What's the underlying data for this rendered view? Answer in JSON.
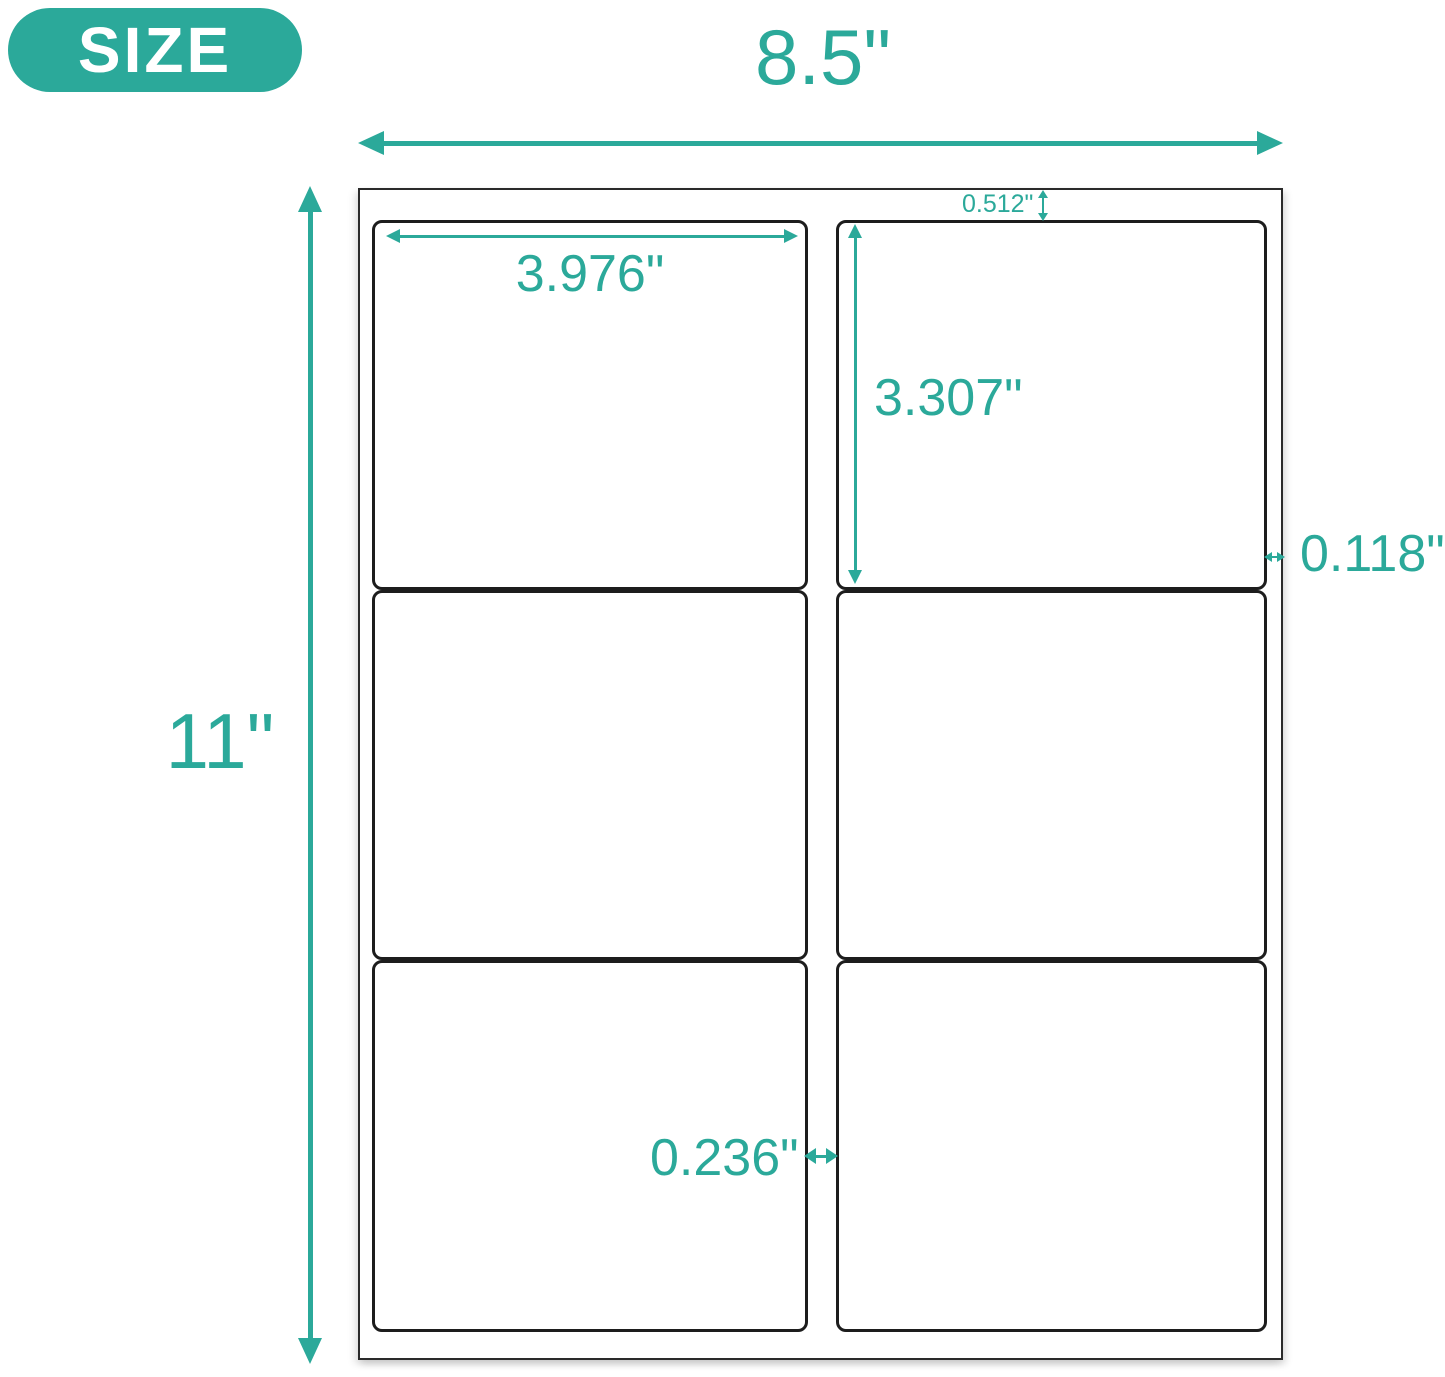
{
  "badge": {
    "label": "SIZE"
  },
  "annotations": {
    "sheet_width": "8.5\"",
    "sheet_height": "11\"",
    "label_width": "3.976\"",
    "label_height": "3.307\"",
    "top_margin": "0.512\"",
    "right_margin": "0.118\"",
    "column_gap": "0.236\""
  },
  "sheet": {
    "columns": 2,
    "rows": 3,
    "label_count": 6
  },
  "colors": {
    "accent": "#2BA99A",
    "label_border": "#1d1d1d",
    "badge_text": "#ffffff"
  }
}
